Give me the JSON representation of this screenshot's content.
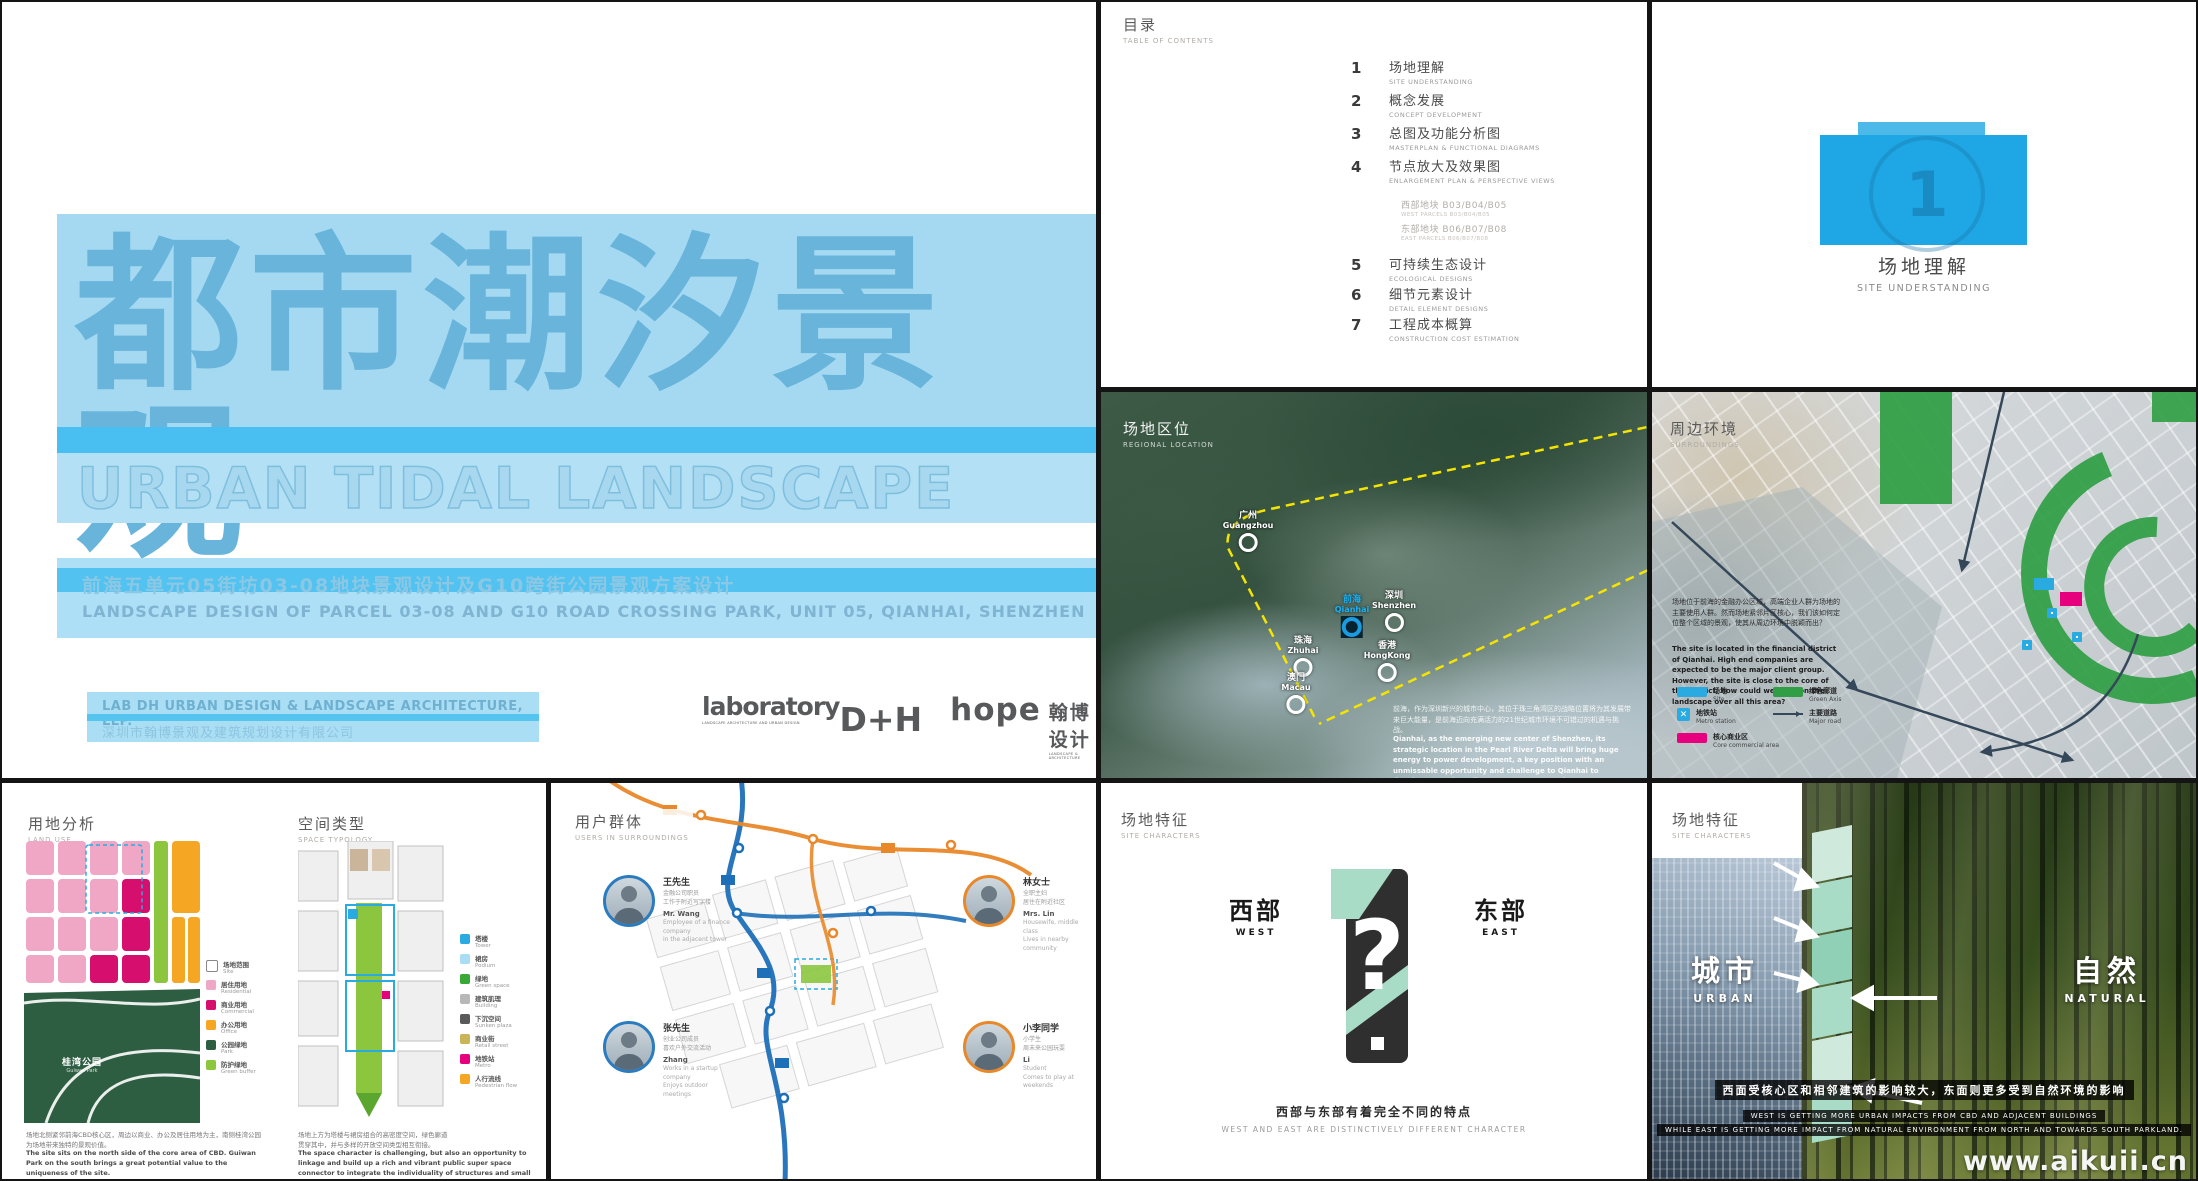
{
  "watermark": "www.aikuii.cn",
  "cover": {
    "title_zh": "都市潮汐景观",
    "title_en": "URBAN TIDAL LANDSCAPE",
    "subtitle_zh": "前海五单元05街坊03-08地块景观设计及G10跨街公园景观方案设计",
    "subtitle_en": "LANDSCAPE DESIGN OF PARCEL 03-08 AND G10 ROAD CROSSING PARK, UNIT 05, QIANHAI, SHENZHEN",
    "firm_en": "LAB DH URBAN DESIGN & LANDSCAPE ARCHITECTURE, LLP.",
    "firm_zh": "深圳市翰博景观及建筑规划设计有限公司",
    "logo1_main": "laboratory",
    "logo1_tag": "LANDSCAPE ARCHITECTURE AND URBAN DESIGN",
    "logo1_dh": "D+H",
    "logo2_main": "hope",
    "logo2_zh": "翰博设计",
    "logo2_tag": "LANDSCAPE & ARCHITECTURE"
  },
  "toc": {
    "title_zh": "目录",
    "title_en": "TABLE OF CONTENTS",
    "items": [
      {
        "num": "1",
        "zh": "场地理解",
        "en": "SITE UNDERSTANDING"
      },
      {
        "num": "2",
        "zh": "概念发展",
        "en": "CONCEPT DEVELOPMENT"
      },
      {
        "num": "3",
        "zh": "总图及功能分析图",
        "en": "MASTERPLAN & FUNCTIONAL DIAGRAMS"
      },
      {
        "num": "4",
        "zh": "节点放大及效果图",
        "en": "ENLARGEMENT PLAN & PERSPECTIVE VIEWS"
      },
      {
        "num": "5",
        "zh": "可持续生态设计",
        "en": "ECOLOGICAL DESIGNS"
      },
      {
        "num": "6",
        "zh": "细节元素设计",
        "en": "DETAIL ELEMENT DESIGNS"
      },
      {
        "num": "7",
        "zh": "工程成本概算",
        "en": "CONSTRUCTION COST ESTIMATION"
      }
    ],
    "subitems": [
      {
        "zh": "西部地块 B03/B04/B05",
        "en": "WEST PARCELS B03/B04/B05"
      },
      {
        "zh": "东部地块 B06/B07/B08",
        "en": "EAST PARCELS B06/B07/B08"
      }
    ]
  },
  "chapter": {
    "num": "1",
    "zh": "场地理解",
    "en": "SITE UNDERSTANDING"
  },
  "regional": {
    "label_zh": "场地区位",
    "label_en": "REGIONAL LOCATION",
    "markers": [
      {
        "zh": "广州",
        "en": "Guangzhou"
      },
      {
        "zh": "深圳",
        "en": "Shenzhen"
      },
      {
        "zh": "前海",
        "en": "Qianhai"
      },
      {
        "zh": "珠海",
        "en": "Zhuhai"
      },
      {
        "zh": "香港",
        "en": "HongKong"
      },
      {
        "zh": "澳门",
        "en": "Macau"
      }
    ],
    "caption_zh": "前海，作为深圳新兴的城市中心，其位于珠三角湾区的战略位置将为其发展带来巨大能量，是前海迈向充满活力的21世纪城市环境不可错过的机遇与挑战。",
    "caption_en": "Qianhai, as the emerging new center of Shenzhen, its strategic location in the Pearl River Delta will bring huge energy to power development, a key position with an unmissable opportunity and challenge to Qianhai to develop towards a vibrant, 21st century urban environment."
  },
  "surroundings": {
    "label_zh": "周边环境",
    "label_en": "SURROUNDINGS",
    "caption_zh": "场地位于前海的金融办公区域，高端企业人群为场地的主要使用人群。然而场地紧邻片区核心，我们该如何定位整个区域的景观，使其从周边环境中脱颖而出？",
    "caption_en": "The site is located in the financial district of Qianhai. High end companies are expected to be the major client group. However, the site is close to the core of the district, how could we position the landscape over all this area?",
    "legend": [
      {
        "zh": "场地",
        "en": "Site",
        "color": "#29abe2"
      },
      {
        "zh": "地铁站",
        "en": "Metro station",
        "color": "#29abe2"
      },
      {
        "zh": "核心商业区",
        "en": "Core commercial area",
        "color": "#e6007e"
      },
      {
        "zh": "绿色廊道",
        "en": "Green Axis",
        "color": "#2f9e44"
      },
      {
        "zh": "主要道路",
        "en": "Major road",
        "color": "#35485a"
      }
    ]
  },
  "landuse": {
    "label_zh": "用地分析",
    "label_en": "LAND USE",
    "park_zh": "桂湾公园",
    "park_en": "Guiwan Park",
    "legend": [
      {
        "zh": "场地范围",
        "en": "Site",
        "color": "#ffffff"
      },
      {
        "zh": "居住用地",
        "en": "Residential",
        "color": "#f0a6c5"
      },
      {
        "zh": "商业用地",
        "en": "Commercial",
        "color": "#d60f6f"
      },
      {
        "zh": "办公用地",
        "en": "Office",
        "color": "#f5a623"
      },
      {
        "zh": "公园绿地",
        "en": "Park",
        "color": "#2e5e42"
      },
      {
        "zh": "防护绿地",
        "en": "Green buffer",
        "color": "#8cc63f"
      }
    ],
    "caption_zh": "场地北侧紧邻前海CBD核心区，周边以商业、办公及居住用地为主，南侧桂湾公园为场地带来独特的景观价值。",
    "caption_en": "The site sits on the north side of the core area of CBD. Guiwan Park on the south brings a great potential value to the uniqueness of the site."
  },
  "typology": {
    "label_zh": "空间类型",
    "label_en": "SPACE TYPOLOGY",
    "legend": [
      {
        "zh": "塔楼",
        "en": "Tower",
        "color": "#29abe2"
      },
      {
        "zh": "裙房",
        "en": "Podium",
        "color": "#a9ddf3"
      },
      {
        "zh": "绿地",
        "en": "Green space",
        "color": "#39a935"
      },
      {
        "zh": "建筑肌理",
        "en": "Building",
        "color": "#b8b8b8"
      },
      {
        "zh": "下沉空间",
        "en": "Sunken plaza",
        "color": "#5a5a5a"
      },
      {
        "zh": "商业街",
        "en": "Retail street",
        "color": "#c9b458"
      },
      {
        "zh": "地铁站",
        "en": "Metro",
        "color": "#e6007e"
      },
      {
        "zh": "人行流线",
        "en": "Pedestrian flow",
        "color": "#f5a623"
      }
    ],
    "caption_zh": "场地上方为塔楼与裙房组合的高密度空间，绿色廊道贯穿其中，并与多样的开放空间类型相互衔接。",
    "caption_en": "The space character is challenging, but also an opportunity to linkage and build up a rich and vibrant public super space connector to integrate the individuality of structures and small spaces."
  },
  "users": {
    "label_zh": "用户群体",
    "label_en": "USERS IN SURROUNDINGS",
    "line_colors": {
      "metro_blue": "#1d6fb8",
      "metro_orange": "#e8882a"
    },
    "cards": [
      {
        "name_zh": "王先生",
        "desc_zh": "金融公司职员\n工作于附近写字楼",
        "name_en": "Mr. Wang",
        "desc_en": "Employee of a finance company\nin the adjacent tower"
      },
      {
        "name_zh": "张先生",
        "desc_zh": "创业公司成员\n喜欢户外交流活动",
        "name_en": "Zhang",
        "desc_en": "Works in a startup company\nEnjoys outdoor meetings"
      },
      {
        "name_zh": "林女士",
        "desc_zh": "全职主妇\n居住在附近社区",
        "name_en": "Mrs. Lin",
        "desc_en": "Housewife, middle class\nLives in nearby community"
      },
      {
        "name_zh": "小李同学",
        "desc_zh": "小学生\n周末来公园玩耍",
        "name_en": "Li",
        "desc_en": "Student\nComes to play at weekends"
      }
    ]
  },
  "westeast": {
    "label_zh": "场地特征",
    "label_en": "SITE CHARACTERS",
    "west_zh": "西部",
    "west_en": "WEST",
    "east_zh": "东部",
    "east_en": "EAST",
    "question_mark": "?",
    "caption_zh": "西部与东部有着完全不同的特点",
    "caption_en": "WEST AND EAST ARE DISTINCTIVELY DIFFERENT CHARACTER"
  },
  "urbannature": {
    "label_zh": "场地特征",
    "label_en": "SITE CHARACTERS",
    "urban_zh": "城市",
    "urban_en": "URBAN",
    "nature_zh": "自然",
    "nature_en": "NATURAL",
    "caption_zh": "西面受核心区和相邻建筑的影响较大，东面则更多受到自然环境的影响",
    "caption_en1": "WEST IS GETTING MORE URBAN IMPACTS FROM CBD AND ADJACENT BUILDINGS",
    "caption_en2": "WHILE EAST IS GETTING MORE IMPACT FROM NATURAL ENVIRONMENT FROM NORTH AND TOWARDS SOUTH PARKLAND."
  }
}
